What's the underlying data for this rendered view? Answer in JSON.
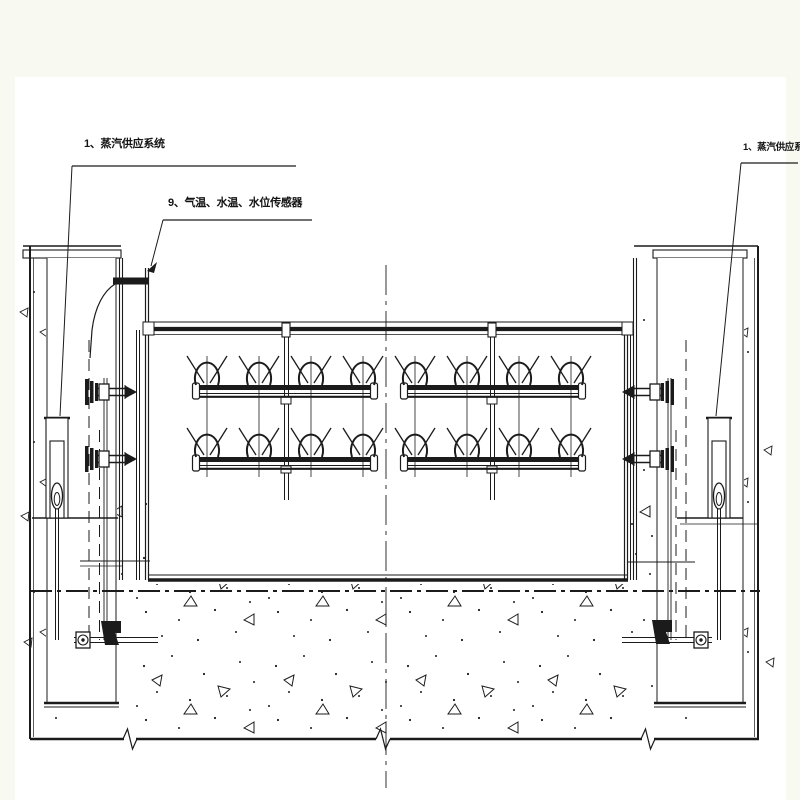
{
  "drawing": {
    "labels": {
      "steam_left": "1、蒸汽供应系统",
      "sensors": "9、气温、水温、水位传感器",
      "steam_right": "1、蒸汽供应系统"
    },
    "colors": {
      "ink": "#1b1b1b",
      "paper": "#ffffff",
      "margin": "#f8faf2"
    }
  }
}
